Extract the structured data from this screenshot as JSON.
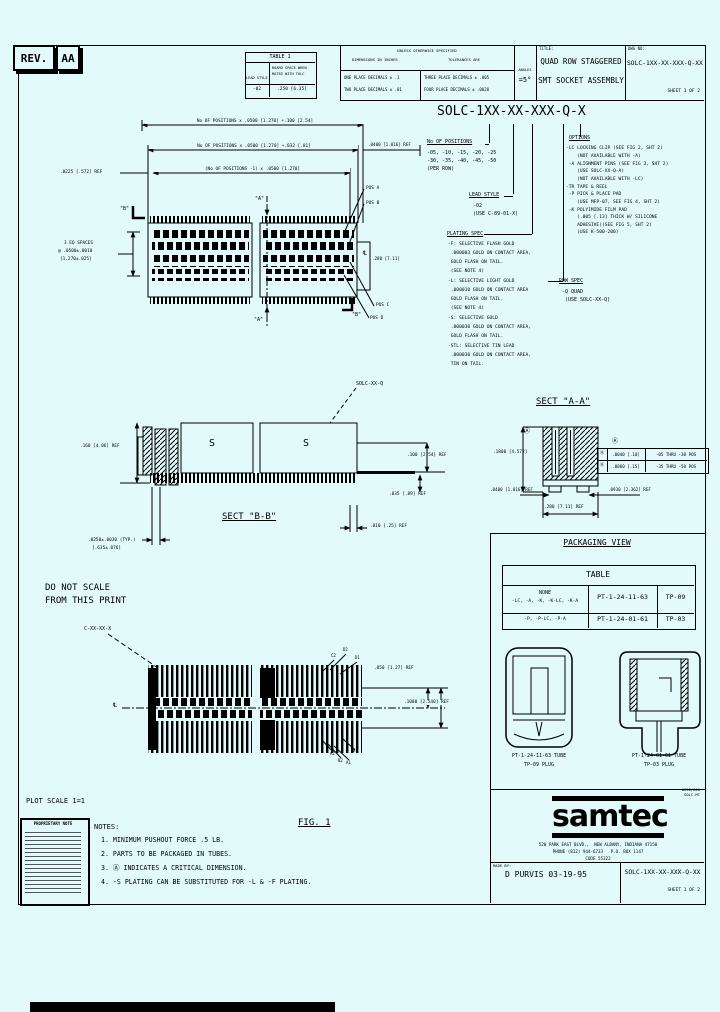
{
  "rev": {
    "label": "REV.",
    "value": "AA"
  },
  "table1": {
    "title": "TABLE 1",
    "col_lead_style": "LEAD STYLE",
    "col_board_space_1": "BOARD SPACE WHEN",
    "col_board_space_2": "MATED WITH TOLC",
    "row_lead": "-02",
    "row_space": ".250 [6.35]"
  },
  "tolerances": {
    "header": "UNLESS OTHERWISE SPECIFIED",
    "sub_left": "DIMENSIONS IN INCHES",
    "sub_right": "TOLERANCES ARE",
    "one_place": "ONE PLACE DECIMALS ± .1",
    "two_place": "TWO PLACE DECIMALS ± .01",
    "three_place": "THREE PLACE DECIMALS ± .005",
    "four_place": "FOUR PLACE DECIMALS ± .0020",
    "angles_label": "ANGLES",
    "angles_value": "=5°"
  },
  "title_block": {
    "title_label": "TITLE:",
    "line1": "QUAD ROW STAGGERED",
    "line2": "SMT SOCKET ASSEMBLY",
    "dwg_label": "DWG NO:",
    "dwg_no": "SOLC-1XX-XX-XXX-Q-XX",
    "sheet": "SHEET 1 OF 2"
  },
  "part_number": {
    "value": "SOLC-1XX-XX-XXX-Q-X",
    "positions_title": "No OF POSITIONS",
    "positions_line1": "-05, -10, -15, -20, -25",
    "positions_line2": "-30, -35, -40, -45, -50",
    "positions_line3": "(PER ROW)",
    "lead_style_title": "LEAD STYLE",
    "lead_style_line1": "-02",
    "lead_style_line2": "(USE C-89-01-X)",
    "plating_title": "PLATING SPEC",
    "plating_lines": [
      "-F: SELECTIVE FLASH GOLD",
      " .000003 GOLD ON CONTACT AREA,",
      " GOLD FLASH ON TAIL.",
      " (SEE NOTE 4)",
      "-L: SELECTIVE LIGHT GOLD",
      " .000010 GOLD ON CONTACT AREA",
      " GOLD FLASH ON TAIL.",
      " (SEE NOTE 4)",
      "-S: SELECTIVE GOLD",
      " .000030 GOLD ON CONTACT AREA,",
      " GOLD FLASH ON TAIL.",
      "-STL: SELECTIVE TIN LEAD",
      " .000030 GOLD ON CONTACT AREA,",
      " TIN ON TAIL."
    ],
    "options_title": "OPTIONS",
    "options_lines": [
      "-LC LOCKING CLIP (SEE FIG 2, SHT 2)",
      "    (NOT AVAILABLE WITH -A)",
      " -A ALIGNMENT PINS (SEE FIG 3, SHT 2)",
      "    (USE SOLC-XX-Q-A)",
      "    (NOT AVAILABLE WITH -LC)",
      "-TR TAPE & REEL",
      " -P PICK & PLACE PAD",
      "    (USE MFP-07, SEE FIG 4, SHT 2)",
      " -K POLYIMIDE FILM PAD",
      "    (.005 [.13] THICK W/ SILICONE",
      "    ADHESIVE)(SEE FIG 5, SHT 2)",
      "    (USE K-500-200)"
    ],
    "row_spec_title": "ROW SPEC",
    "row_spec_line1": "-Q QUAD",
    "row_spec_line2": "(USE SOLC-XX-Q)"
  },
  "top_view": {
    "dim1": "No OF POSITIONS x .0500 [1.270] +.100 [2.54]",
    "dim2": "No OF POSITIONS x .0500 [1.270] +.032 [.81]",
    "dim3": "(No OF POSITIONS -1) x .0500 [1.270]",
    "dim_left": ".0225 [.572] REF",
    "dim_right": ".0400 [1.016] REF",
    "eq_spaces1": "3 EQ SPACES",
    "eq_spaces2": "@ .0500±.0010",
    "eq_spaces3": "[1.270±.025]",
    "pos_a": "POS A",
    "pos_b": "POS B",
    "pos_c": "POS C",
    "pos_d": "POS D",
    "dim_width": ".280 [7.11]",
    "centerline": "℄",
    "mark_a": "\"A\"",
    "mark_b": "\"B\"",
    "part_label": "SOLC-XX-Q"
  },
  "sect_bb": {
    "label": "SECT \"B-B\"",
    "s_mark": "S",
    "dim_height": ".160 [4.06] REF",
    "dim_board": ".100 [2.54] REF",
    "dim_standoff": ".035 [.89] REF",
    "dim_tail": ".010 [.25] REF",
    "dim_pitch1": ".0250±.0030 (TYP.)",
    "dim_pitch2": "[.635±.076]"
  },
  "do_not_scale1": "DO NOT SCALE",
  "do_not_scale2": "FROM THIS PRINT",
  "sect_aa": {
    "label": "SECT \"A-A\"",
    "dim_height": ".1800 [4.572]",
    "datum": "Ⓐ",
    "table_rows": [
      [
        "Ⓐ",
        ".0040 [.10]",
        "-05 THRU -30 POS"
      ],
      [
        "Ⓐ",
        ".0060 [.15]",
        "-35 THRU -50 POS"
      ]
    ],
    "dim_left": ".0400 [1.016] REF",
    "dim_right": ".0930 [2.362] REF",
    "dim_width": ".280 [7.11] REF"
  },
  "packaging": {
    "heading": "PACKAGING VIEW",
    "table_title": "TABLE",
    "r1c1a": "NONE",
    "r1c1b": "-LC, -A, -K, -K-LC, -K-A",
    "r1c2": "PT-1-24-11-63",
    "r1c3": "TP-09",
    "r2c1": "-P, -P-LC, -P-A",
    "r2c2": "PT-1-24-01-61",
    "r2c3": "TP-03",
    "tube1_line1": "PT-1-24-11-63 TUBE",
    "tube1_line2": "TP-09 PLUG",
    "tube2_line1": "PT-1-24-01-61 TUBE",
    "tube2_line2": "TP-03 PLUG"
  },
  "fig1": {
    "heading": "FIG. 1",
    "part_label": "C-XX-XX-X",
    "centerline": "℄",
    "dim_pitch": ".050 [1.27] REF",
    "dim_row": ".1000 [2.540] REF",
    "lbl_c2": "C2",
    "lbl_d2": "D2",
    "lbl_d1": "D1",
    "lbl_a2": "A2",
    "lbl_b2": "B2",
    "lbl_a1": "A1",
    "lbl_b1": "B1"
  },
  "notes": {
    "heading": "NOTES:",
    "items": [
      "1. MINIMUM PUSHOUT FORCE .5 LB.",
      "2. PARTS TO BE PACKAGED IN TUBES.",
      "3. Ⓐ INDICATES A CRITICAL DIMENSION.",
      "4. -S PLATING CAN BE SUBSTITUTED FOR -L & -F PLATING."
    ]
  },
  "plot_scale": "PLOT SCALE 1=1",
  "proprietary": {
    "heading": "PROPRIETARY NOTE"
  },
  "footer": {
    "logo": "samtec",
    "addr1": "520 PARK EAST BLVD.,  NEW ALBANY, INDIANA 47150",
    "addr2": "PHONE (812) 944-6733   P.O. BOX 1147",
    "addr3": "CODE 55322",
    "small1": "#650/600",
    "small2": "SOLC-MT",
    "made_by_label": "MADE BY:",
    "made_by": "D PURVIS 03-19-95",
    "dwg_no": "SOLC-1XX-XX-XXX-Q-XX",
    "sheet": "SHEET 1 OF 2"
  }
}
